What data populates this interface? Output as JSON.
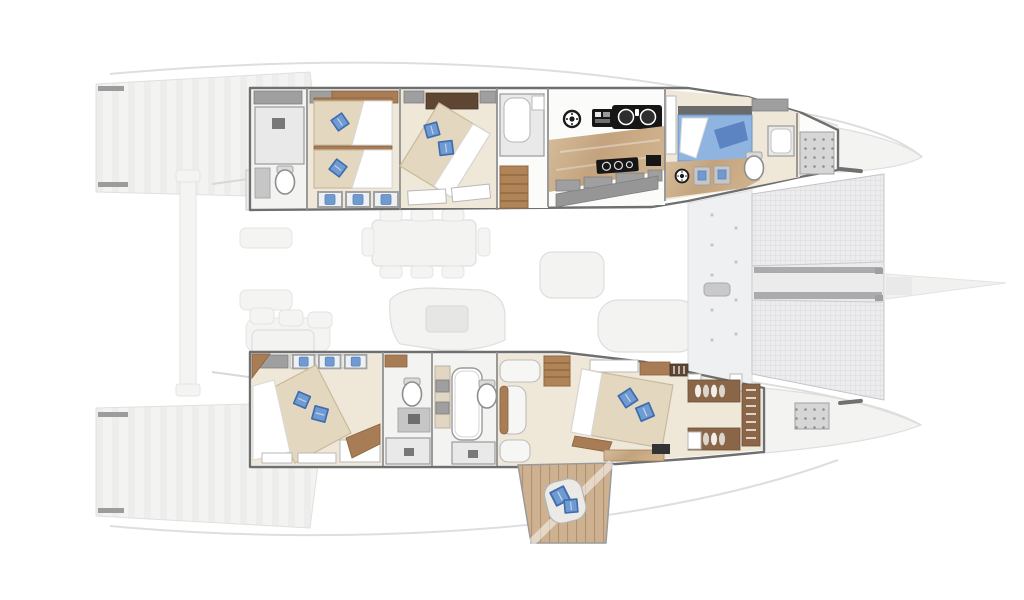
{
  "meta": {
    "view": "overhead-deck-plan",
    "vessel_type": "sailing-catamaran"
  },
  "colors": {
    "bg": "#ffffff",
    "wall": "#6f6f6f",
    "partition": "#8f8f8f",
    "floor_cabin": "#efe8d9",
    "floor_white": "#fbfbfa",
    "bed_base": "#e3d7bf",
    "bed_edge": "#c9ba9c",
    "duvet": "#ffffff",
    "pillow_main": "#6f9ad2",
    "pillow_edge": "#3f6cae",
    "bed_blue": "#8fb4e0",
    "bed_blue_deep": "#5d84c2",
    "wood_deep": "#a87c54",
    "wood_dark": "#8a6547",
    "headboard": "#5f4632",
    "cab_gray": "#9f9f9f",
    "cab_gray_light": "#c6c6c6",
    "appliance": "#161616",
    "ghost_fill": "#f3f3f2",
    "ghost_edge": "#dedede",
    "deck_gray": "#eef0f1",
    "walkway_band": "#ababae",
    "platform_wood": "#cdb191",
    "platform_line": "#b0926f",
    "trampoline_fill": "#ececee",
    "trampoline_line": "#d4d4d8"
  },
  "vessel": {
    "port_hull_rooms": [
      "aft-head",
      "twin-guest-cabin",
      "vip-double-cabin",
      "mid-head",
      "galley",
      "forward-cabin",
      "forepeak-locker"
    ],
    "starboard_hull_rooms": [
      "guest-double-cabin",
      "head",
      "shower-room",
      "master-suite",
      "private-aft-platform"
    ],
    "bridge_deck": [
      "aft-cockpit",
      "saloon-dining",
      "saloon-lounge",
      "helm-lounge"
    ],
    "foredeck": [
      "side-deck",
      "trampoline-port",
      "trampoline-starboard",
      "center-walkway",
      "windlass",
      "bowsprit"
    ]
  },
  "icons": {
    "pillow": "blue-diamond-cushion",
    "window": "hull-porthole",
    "washer": "round-appliance-porthole",
    "sink": "double-galley-sink",
    "cooktop": "gas-hob",
    "toilet": "marine-toilet",
    "wardrobe": "hanging-clothes"
  }
}
